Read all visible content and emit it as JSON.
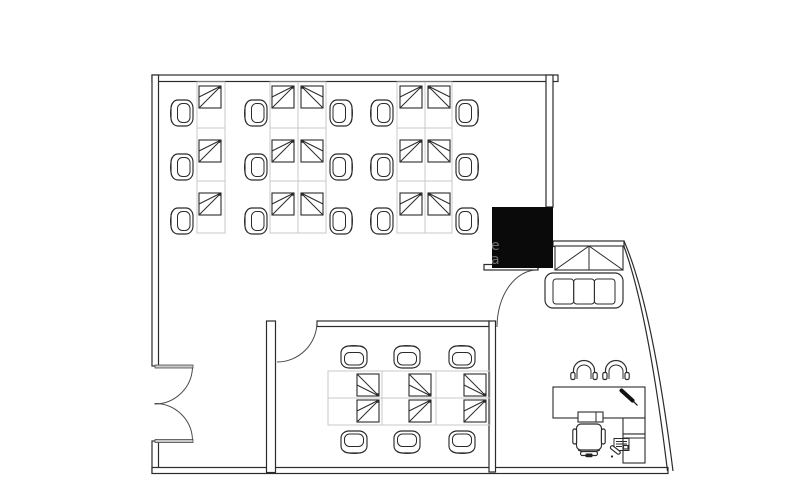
{
  "meta": {
    "kind": "office-floor-plan",
    "width": 805,
    "height": 485
  },
  "palette": {
    "background": "#ffffff",
    "line": "#2b2b2b",
    "grid": "#c9c9c9",
    "shaft": "#0a0a0a",
    "watermark": "rgba(255,255,255,0.42)"
  },
  "watermark": {
    "chars": [
      "e",
      "a"
    ]
  },
  "inventory": {
    "open_office": {
      "workstation_desks": 15,
      "chairs": 15
    },
    "meeting_room": {
      "desk_modules": 6,
      "chairs": 6
    },
    "reception": {
      "sofas": 1,
      "sofa_seats": 3,
      "cabinets": 1
    },
    "private_office": {
      "desks": 1,
      "visitor_chairs": 2,
      "task_chairs": 1,
      "side_cabinets": 1,
      "keyboards": 1,
      "pens": 1,
      "printers": 1
    },
    "core_shafts": 1,
    "doors": {
      "double_leaf": 1,
      "single_leaf": 2
    }
  },
  "furniture": {
    "desks": [
      {
        "x": 199,
        "y": 86,
        "o": "tr"
      },
      {
        "x": 199,
        "y": 140,
        "o": "tr"
      },
      {
        "x": 199,
        "y": 193,
        "o": "tr"
      },
      {
        "x": 272,
        "y": 86,
        "o": "tr"
      },
      {
        "x": 272,
        "y": 140,
        "o": "tr"
      },
      {
        "x": 272,
        "y": 193,
        "o": "tr"
      },
      {
        "x": 301,
        "y": 86,
        "o": "tl"
      },
      {
        "x": 301,
        "y": 140,
        "o": "tl"
      },
      {
        "x": 301,
        "y": 193,
        "o": "tl"
      },
      {
        "x": 400,
        "y": 86,
        "o": "tr"
      },
      {
        "x": 400,
        "y": 140,
        "o": "tr"
      },
      {
        "x": 400,
        "y": 193,
        "o": "tr"
      },
      {
        "x": 428,
        "y": 86,
        "o": "tl"
      },
      {
        "x": 428,
        "y": 140,
        "o": "tl"
      },
      {
        "x": 428,
        "y": 193,
        "o": "tl"
      },
      {
        "x": 357,
        "y": 374,
        "o": "br"
      },
      {
        "x": 409,
        "y": 374,
        "o": "br"
      },
      {
        "x": 464,
        "y": 374,
        "o": "br"
      },
      {
        "x": 357,
        "y": 400,
        "o": "tr"
      },
      {
        "x": 409,
        "y": 400,
        "o": "tr"
      },
      {
        "x": 464,
        "y": 400,
        "o": "tr"
      }
    ],
    "chairs": [
      {
        "x": 167,
        "y": 99,
        "r": 0
      },
      {
        "x": 167,
        "y": 153,
        "r": 0
      },
      {
        "x": 167,
        "y": 207,
        "r": 0
      },
      {
        "x": 241,
        "y": 99,
        "r": 0
      },
      {
        "x": 241,
        "y": 153,
        "r": 0
      },
      {
        "x": 241,
        "y": 207,
        "r": 0
      },
      {
        "x": 367,
        "y": 99,
        "r": 0
      },
      {
        "x": 367,
        "y": 153,
        "r": 0
      },
      {
        "x": 367,
        "y": 207,
        "r": 0
      },
      {
        "x": 330,
        "y": 99,
        "r": 180
      },
      {
        "x": 330,
        "y": 153,
        "r": 180
      },
      {
        "x": 330,
        "y": 207,
        "r": 180
      },
      {
        "x": 456,
        "y": 99,
        "r": 180
      },
      {
        "x": 456,
        "y": 153,
        "r": 180
      },
      {
        "x": 456,
        "y": 207,
        "r": 180
      },
      {
        "x": 341,
        "y": 341,
        "r": 90
      },
      {
        "x": 394,
        "y": 341,
        "r": 90
      },
      {
        "x": 449,
        "y": 341,
        "r": 90
      },
      {
        "x": 341,
        "y": 430,
        "r": 270
      },
      {
        "x": 394,
        "y": 430,
        "r": 270
      },
      {
        "x": 449,
        "y": 430,
        "r": 270
      }
    ],
    "visitor_chairs": [
      {
        "x": 570,
        "y": 357
      },
      {
        "x": 602,
        "y": 357
      }
    ],
    "task_chair": {
      "x": 572,
      "y": 422
    }
  }
}
